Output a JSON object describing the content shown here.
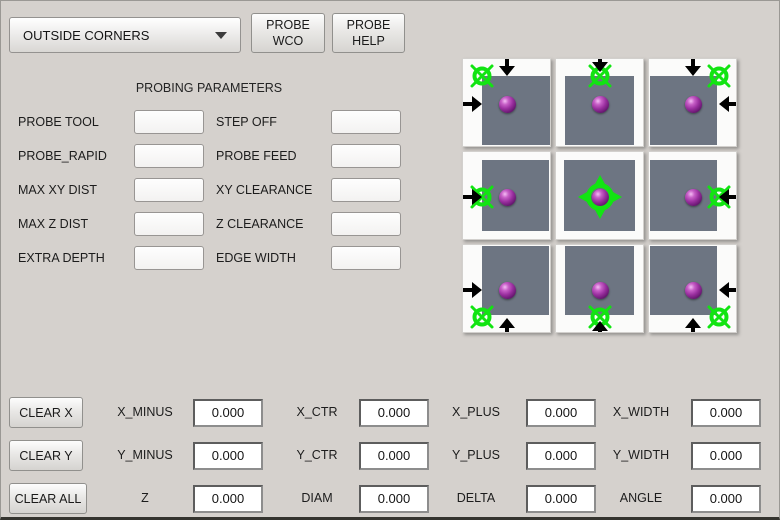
{
  "header": {
    "mode_dropdown": {
      "value": "OUTSIDE CORNERS"
    },
    "probe_wco_button": {
      "lines": [
        "PROBE",
        "WCO"
      ]
    },
    "probe_help_button": {
      "lines": [
        "PROBE",
        "HELP"
      ]
    }
  },
  "parameters": {
    "title": "PROBING PARAMETERS",
    "left": [
      {
        "label": "PROBE TOOL",
        "value": ""
      },
      {
        "label": "PROBE_RAPID",
        "value": ""
      },
      {
        "label": "MAX XY DIST",
        "value": ""
      },
      {
        "label": "MAX Z DIST",
        "value": ""
      },
      {
        "label": "EXTRA DEPTH",
        "value": ""
      }
    ],
    "right": [
      {
        "label": "STEP OFF",
        "value": ""
      },
      {
        "label": "PROBE FEED",
        "value": ""
      },
      {
        "label": "XY CLEARANCE",
        "value": ""
      },
      {
        "label": "Z CLEARANCE",
        "value": ""
      },
      {
        "label": "EDGE WIDTH",
        "value": ""
      }
    ]
  },
  "illustration": {
    "description": "3x3 grid of outside-corner probing diagrams: gray workpiece on white tile, purple probe ball, green target marker, black approach arrows",
    "marker_color": "#12e412",
    "surface_color": "#6d7582",
    "sphere_color": "#9a2f9f",
    "cells": [
      {
        "position": "top-left",
        "marker": "corner-top-left",
        "arrows": [
          "down",
          "right"
        ]
      },
      {
        "position": "top-center",
        "marker": "edge-top",
        "arrows": [
          "down"
        ]
      },
      {
        "position": "top-right",
        "marker": "corner-top-right",
        "arrows": [
          "down",
          "left"
        ]
      },
      {
        "position": "middle-left",
        "marker": "edge-left",
        "arrows": [
          "right"
        ]
      },
      {
        "position": "center",
        "marker": "center",
        "arrows": []
      },
      {
        "position": "middle-right",
        "marker": "edge-right",
        "arrows": [
          "left"
        ]
      },
      {
        "position": "bottom-left",
        "marker": "corner-bottom-left",
        "arrows": [
          "right",
          "up"
        ]
      },
      {
        "position": "bottom-center",
        "marker": "edge-bottom",
        "arrows": [
          "up"
        ]
      },
      {
        "position": "bottom-right",
        "marker": "corner-bottom-right",
        "arrows": [
          "left",
          "up"
        ]
      }
    ]
  },
  "results": {
    "rows": [
      {
        "button": "CLEAR X",
        "fields": [
          {
            "label": "X_MINUS",
            "value": "0.000"
          },
          {
            "label": "X_CTR",
            "value": "0.000"
          },
          {
            "label": "X_PLUS",
            "value": "0.000"
          },
          {
            "label": "X_WIDTH",
            "value": "0.000"
          }
        ]
      },
      {
        "button": "CLEAR Y",
        "fields": [
          {
            "label": "Y_MINUS",
            "value": "0.000"
          },
          {
            "label": "Y_CTR",
            "value": "0.000"
          },
          {
            "label": "Y_PLUS",
            "value": "0.000"
          },
          {
            "label": "Y_WIDTH",
            "value": "0.000"
          }
        ]
      },
      {
        "button": "CLEAR ALL",
        "fields": [
          {
            "label": "Z",
            "value": "0.000"
          },
          {
            "label": "DIAM",
            "value": "0.000"
          },
          {
            "label": "DELTA",
            "value": "0.000"
          },
          {
            "label": "ANGLE",
            "value": "0.000"
          }
        ]
      }
    ]
  }
}
